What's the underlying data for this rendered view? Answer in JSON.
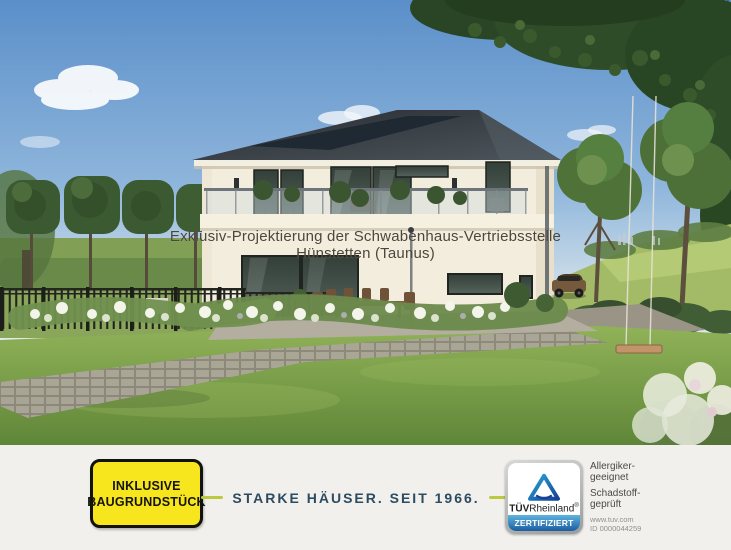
{
  "photo": {
    "overlay_line1": "Exklusiv-Projektierung der Schwabenhaus-Vertriebsstelle",
    "overlay_line2": "Hünstetten (Taunus)"
  },
  "banner": {
    "badge": {
      "line1": "INKLUSIVE",
      "line2": "BAUGRUNDSTÜCK"
    },
    "slogan": "STARKE HÄUSER. SEIT 1966.",
    "tuv": {
      "brand_tuv": "TÜV",
      "brand_rheinland": "Rheinland",
      "registered": "®",
      "certified": "ZERTIFIZIERT",
      "claims": [
        "Allergiker-geeignet",
        "Schadstoff-geprüft"
      ],
      "url": "www.tuv.com",
      "id": "ID 0000044259"
    }
  },
  "colors": {
    "badge_yellow": "#f7e51e",
    "slogan_navy": "#2c4b61",
    "dash_olive": "#bcc93e",
    "tuv_blue_dark": "#164194",
    "tuv_blue_light": "#29a8d8",
    "banner_background": "#f1f0ec",
    "sky_blue": "#5b8fc9",
    "lawn_green": "#7d9c4e"
  }
}
